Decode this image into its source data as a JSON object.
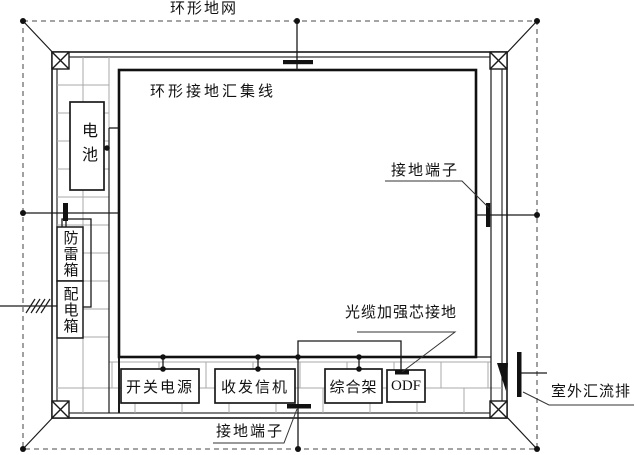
{
  "diagram": {
    "title_labels": {
      "ring_ground_network": "环形地网",
      "ring_ground_busbar": "环形接地汇集线",
      "ground_terminal_right": "接地端子",
      "ground_terminal_bottom": "接地端子",
      "fiber_strength_member_ground": "光缆加强芯接地",
      "outdoor_busbar": "室外汇流排"
    },
    "equipment": {
      "battery": "电池",
      "lightning_protection_box": "防雷箱",
      "power_distribution_box": "配电箱",
      "switch_power": "开关电源",
      "transceiver": "收发信机",
      "integrated_rack": "综合架",
      "odf": "ODF"
    },
    "colors": {
      "line": "#1a1a1a",
      "brick": "#a8a8a8",
      "dashed_ring": "#6e6e6e",
      "background": "#ffffff"
    }
  }
}
